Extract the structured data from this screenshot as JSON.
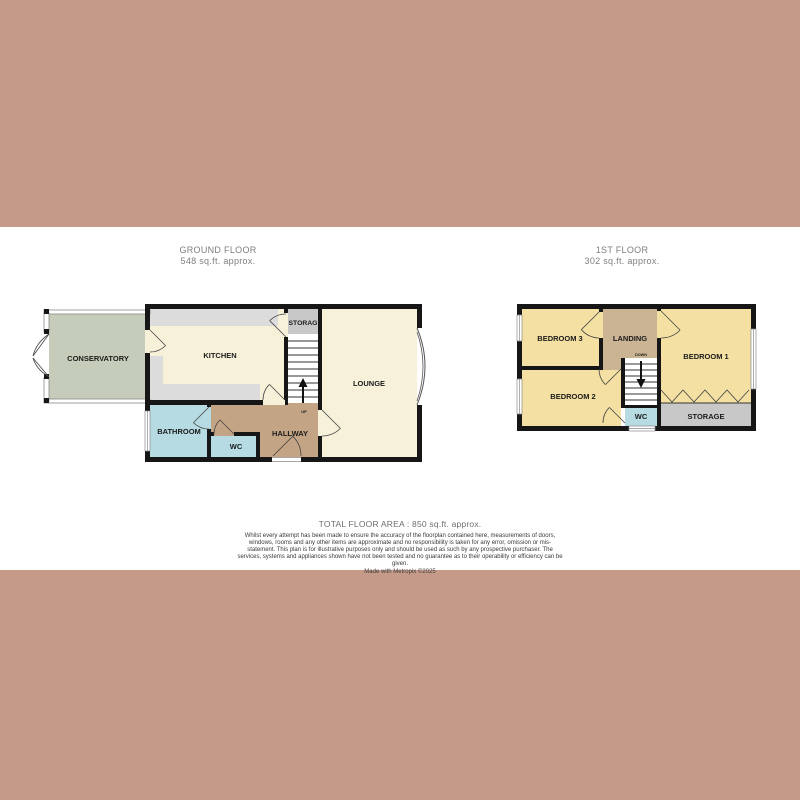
{
  "ground_floor": {
    "title": "GROUND FLOOR",
    "subtitle": "548 sq.ft. approx.",
    "rooms": {
      "conservatory": "CONSERVATORY",
      "kitchen": "KITCHEN",
      "storage": "STORAG",
      "lounge": "LOUNGE",
      "bathroom": "BATHROOM",
      "wc": "WC",
      "hallway": "HALLWAY"
    },
    "stairs_label": "UP"
  },
  "first_floor": {
    "title": "1ST FLOOR",
    "subtitle": "302 sq.ft. approx.",
    "rooms": {
      "bedroom1": "BEDROOM 1",
      "bedroom2": "BEDROOM 2",
      "bedroom3": "BEDROOM 3",
      "landing": "LANDING",
      "wc": "WC",
      "storage": "STORAGE"
    },
    "stairs_label": "DOWN"
  },
  "footer": {
    "total_area": "TOTAL FLOOR AREA : 850 sq.ft. approx.",
    "disclaimer": "Whilst every attempt has been made to ensure the accuracy of the floorplan contained here, measurements of doors, windows, rooms and any other items are approximate and no responsibility is taken for any error, omission or mis-statement. This plan is for illustrative purposes only and should be used as such by any prospective purchaser. The services, systems and appliances shown have not been tested and no guarantee as to their operability or efficiency can be given.",
    "credit": "Made with Metropix ©2025"
  },
  "colors": {
    "border_band": "#c69a88",
    "wall": "#161616",
    "cream_room": "#f7f1d9",
    "yellow_room": "#f3e0a2",
    "hallway_tan": "#c3a485",
    "landing_tan": "#cbb493",
    "bathroom_blue": "#b6dbe2",
    "conservatory_green": "#c5ccba",
    "counter_gray": "#dcdcdc",
    "storage_gray": "#c8c8c8",
    "title_gray": "#7e7e7e"
  }
}
